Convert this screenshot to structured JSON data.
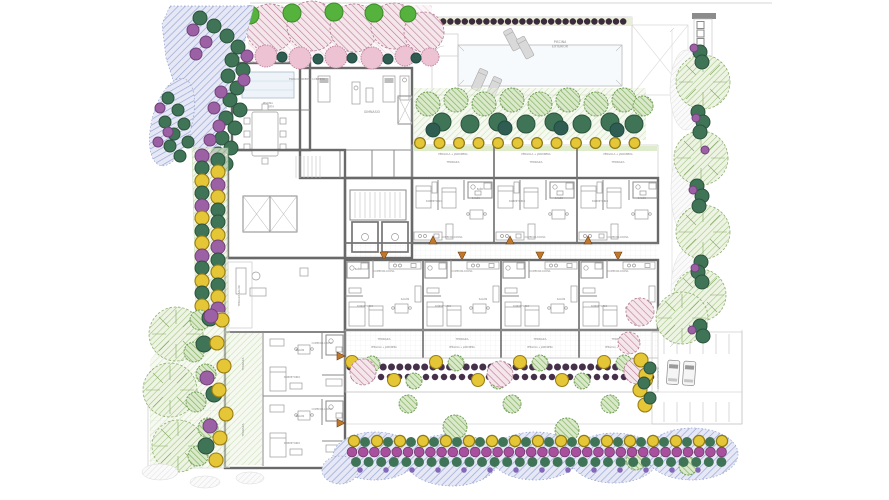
{
  "areas": {
    "pool": {
      "line1": "PISCINA",
      "line2": "EXTERIOR"
    },
    "indoor_pool": {
      "line1": "PISCINA",
      "line2": "CUBIERTA"
    },
    "common": {
      "open_space": "ESPACIO ABIERTO CUBIERTO",
      "gym": "GIMNASIO",
      "lounge_terrace": "TERRAZA SALÓN"
    },
    "unit_rooms": {
      "bedroom": "DORMITORIO",
      "living": "SALÓN",
      "kitchen": "COMEDOR-COCINA",
      "bath": "BAÑO",
      "terrace": "TERRAZA",
      "pergola": "PÉRGOLA + JARDINERA"
    },
    "parking": {
      "label": "APARCAMIENTO"
    }
  },
  "palette": {
    "wall": "#696969",
    "partition": "#8a8a8a",
    "label_text": "#8a8a8a",
    "lavender_groundcover": "#aab3d9",
    "tree_light_green": "#b9d49c",
    "tree_medium_green": "#8cbd68",
    "tree_dark_green": "#3f7457",
    "tree_teal": "#2f5d52",
    "tree_bright_green": "#55b23c",
    "shrub_yellow": "#e4c636",
    "shrub_purple": "#9c61a5",
    "shrub_magenta": "#a84f9e",
    "tree_pink": "#d8a4b4",
    "shrub_pink": "#edc2d3",
    "hedge_dot": "#46304a",
    "door_marker": "#c0772b",
    "lounger": "#d9d9d9"
  }
}
